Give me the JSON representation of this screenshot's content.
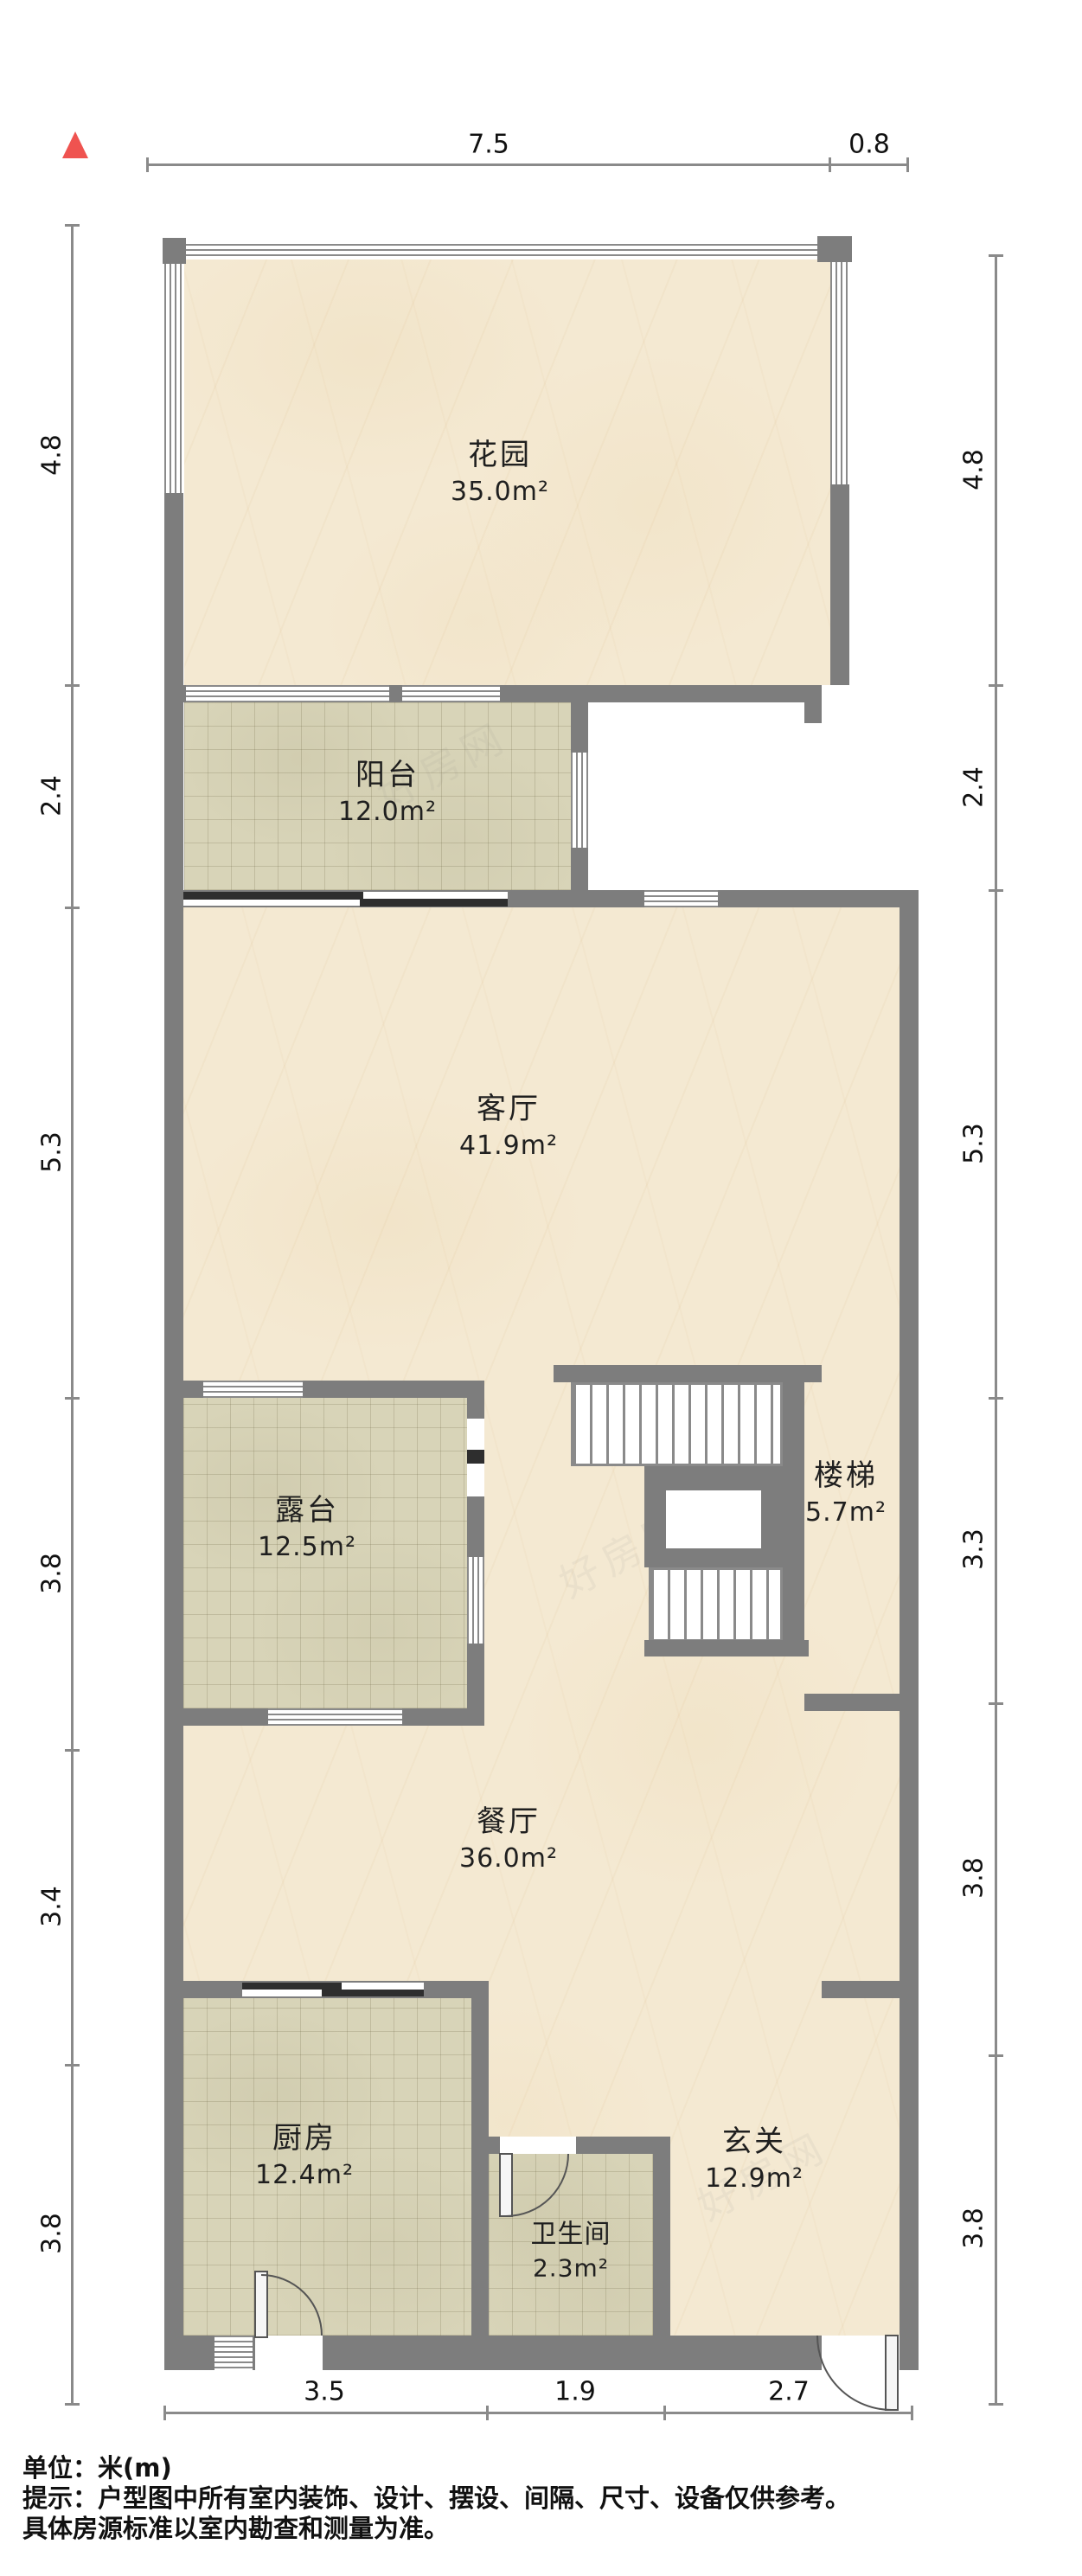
{
  "north_indicator": {
    "icon": "north-arrow",
    "color": "#ef5350"
  },
  "rooms": [
    {
      "id": "garden",
      "name": "花园",
      "area": "35.0m²"
    },
    {
      "id": "balcony",
      "name": "阳台",
      "area": "12.0m²"
    },
    {
      "id": "living",
      "name": "客厅",
      "area": "41.9m²"
    },
    {
      "id": "terrace",
      "name": "露台",
      "area": "12.5m²"
    },
    {
      "id": "stairs",
      "name": "楼梯",
      "area": "5.7m²"
    },
    {
      "id": "dining",
      "name": "餐厅",
      "area": "36.0m²"
    },
    {
      "id": "kitchen",
      "name": "厨房",
      "area": "12.4m²"
    },
    {
      "id": "bathroom",
      "name": "卫生间",
      "area": "2.3m²"
    },
    {
      "id": "entry",
      "name": "玄关",
      "area": "12.9m²"
    }
  ],
  "dimensions": {
    "top": [
      "7.5",
      "0.8"
    ],
    "left": [
      "4.8",
      "2.4",
      "5.3",
      "3.8",
      "3.4",
      "3.8"
    ],
    "right": [
      "4.8",
      "2.4",
      "5.3",
      "3.3",
      "3.8",
      "3.8"
    ],
    "bottom": [
      "3.5",
      "1.9",
      "2.7"
    ]
  },
  "notes": {
    "line1": "单位：米(m)",
    "line2": "提示：户型图中所有室内装饰、设计、摆设、间隔、尺寸、设备仅供参考。",
    "line3": "具体房源标准以室内勘查和测量为准。"
  },
  "watermark": {
    "text": "好房网"
  },
  "colors": {
    "wall": "#7d7d7d",
    "marble_floor": "#f4e9d2",
    "tile_floor": "#d8d4b8",
    "dimension_line": "#8a8a8a",
    "north_arrow": "#ef5350"
  }
}
